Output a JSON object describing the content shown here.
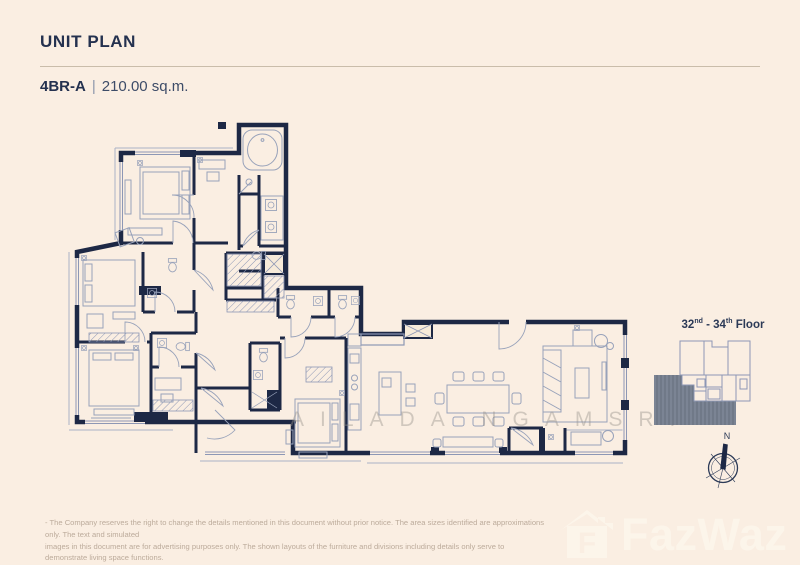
{
  "page": {
    "background": "#faeee2"
  },
  "header": {
    "title": "UNIT PLAN",
    "unit_code": "4BR-A",
    "separator": "|",
    "area": "210.00 sq.m."
  },
  "plan": {
    "watermark": "AILADA NGAMSRI"
  },
  "keyplan": {
    "floor_a": "32",
    "sup_a": "nd",
    "floor_b": " - 34",
    "sup_b": "th",
    "floor_c": " Floor"
  },
  "compass": {
    "north": "N"
  },
  "footer": {
    "line1": "- The Company reserves the right to change the details mentioned in this document without prior notice. The area sizes identified are approximations only. The text and simulated",
    "line2": "images in this document are for advertising purposes only. The shown layouts of the furniture and divisions including details only serve to demonstrate living space functions."
  },
  "logo": {
    "brand": "FazWaz",
    "icon_letter": "F"
  },
  "colors": {
    "navy": "#24314f",
    "wall": "#1d2845",
    "furniture_line": "#98a2ba",
    "keyplan_shade": "#7b8494",
    "watermark_gray": "#b9b4aa",
    "disclaimer_text": "#bcab9b",
    "logo_white": "#fdf6ec"
  }
}
